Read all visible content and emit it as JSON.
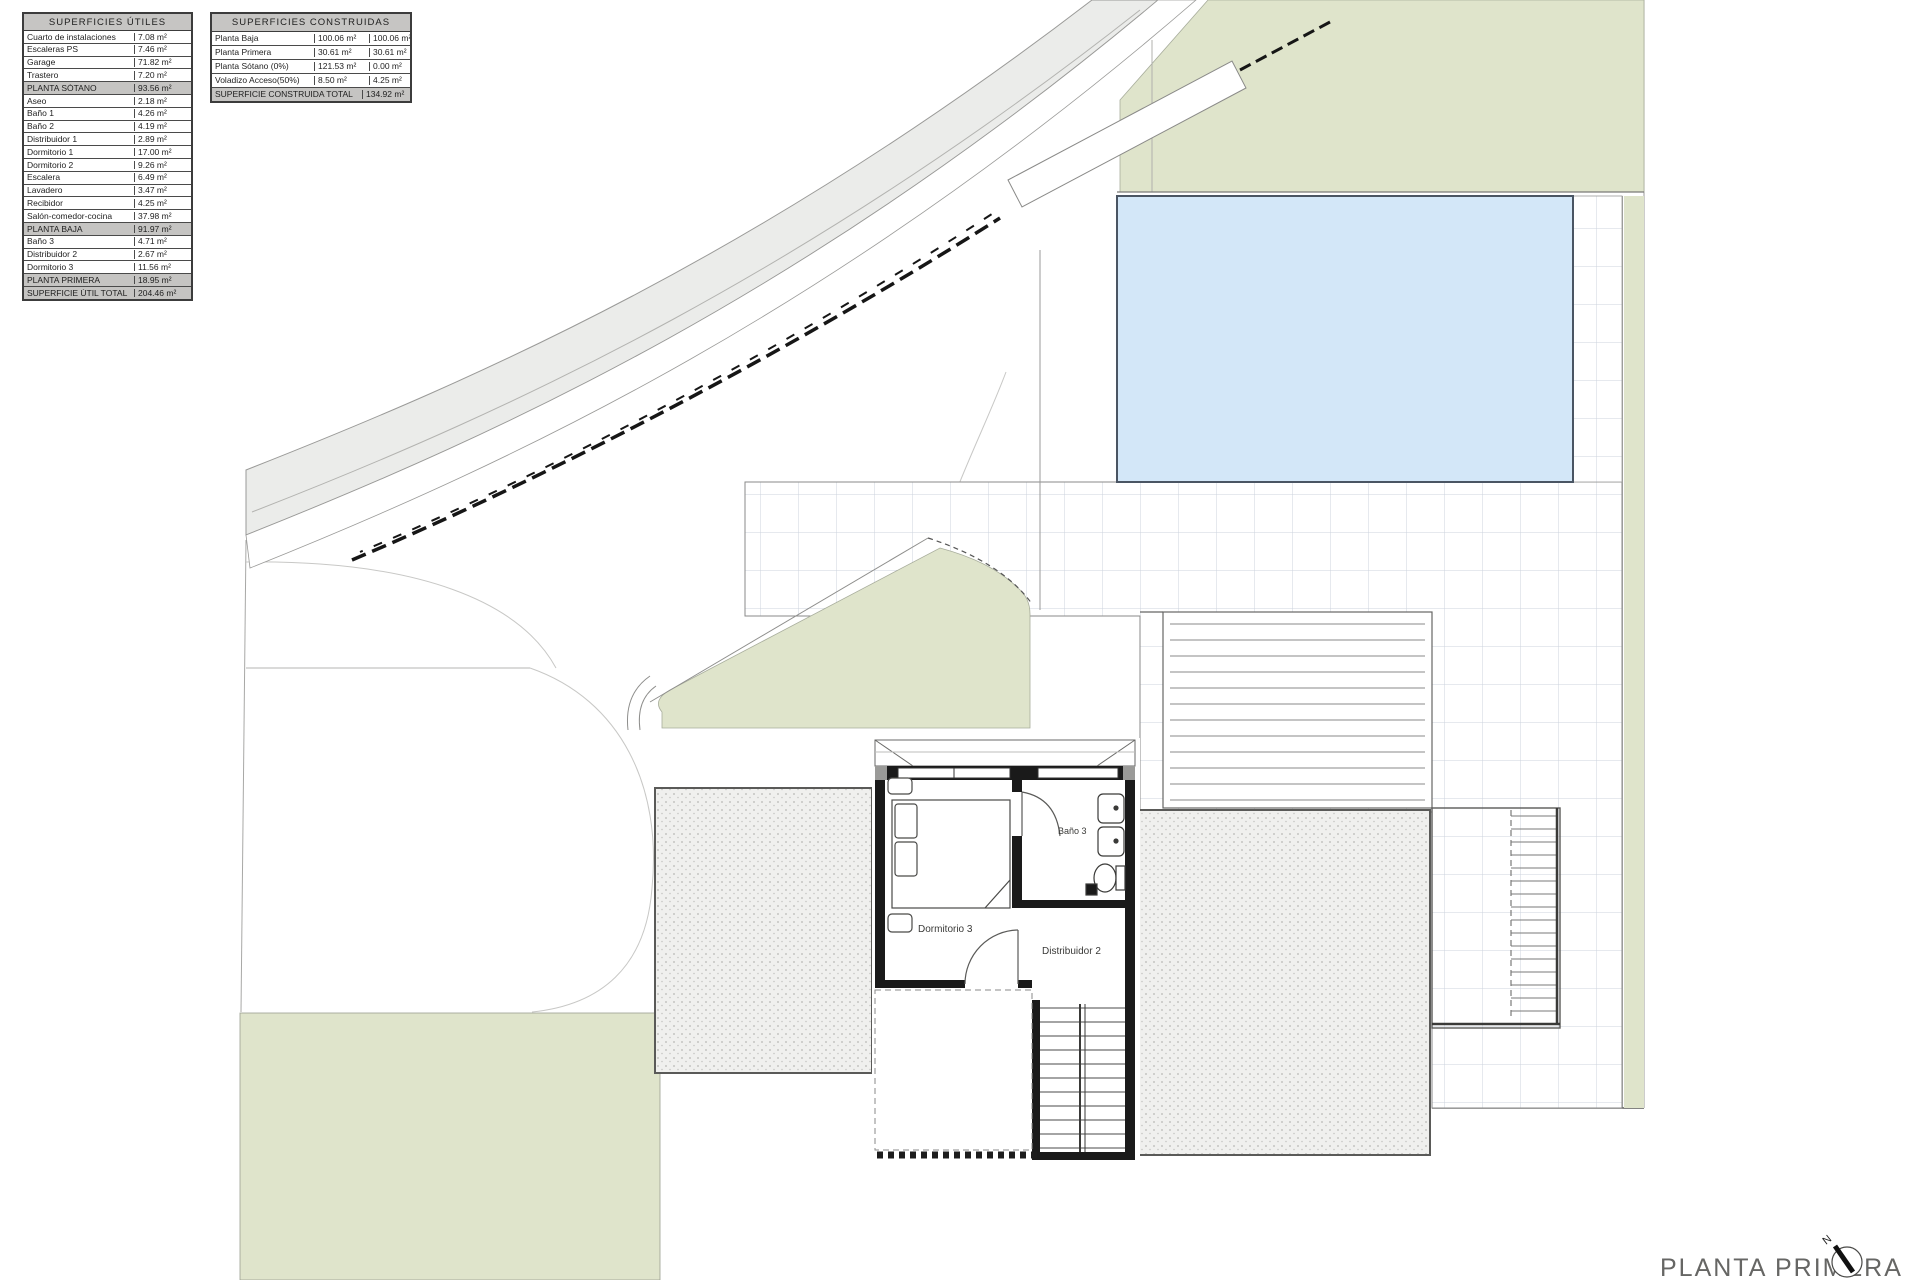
{
  "plan": {
    "title": "PLANTA PRIMERA",
    "north_label": "N",
    "rooms": {
      "dormitorio": "Dormitorio 3",
      "bano": "Baño 3",
      "distribuidor": "Distribuidor 2"
    }
  },
  "tables": {
    "superficies_utiles": {
      "title": "SUPERFICIES ÚTILES",
      "rows": [
        {
          "label": "Cuarto de instalaciones",
          "value": "7.08 m²",
          "type": "normal"
        },
        {
          "label": "Escaleras PS",
          "value": "7.46 m²",
          "type": "normal"
        },
        {
          "label": "Garage",
          "value": "71.82 m²",
          "type": "normal"
        },
        {
          "label": "Trastero",
          "value": "7.20 m²",
          "type": "normal"
        },
        {
          "label": "PLANTA SÓTANO",
          "value": "93.56 m²",
          "type": "subtotal"
        },
        {
          "label": "Aseo",
          "value": "2.18 m²",
          "type": "normal"
        },
        {
          "label": "Baño 1",
          "value": "4.26 m²",
          "type": "normal"
        },
        {
          "label": "Baño 2",
          "value": "4.19 m²",
          "type": "normal"
        },
        {
          "label": "Distribuidor 1",
          "value": "2.89 m²",
          "type": "normal"
        },
        {
          "label": "Dormitorio 1",
          "value": "17.00 m²",
          "type": "normal"
        },
        {
          "label": "Dormitorio 2",
          "value": "9.26 m²",
          "type": "normal"
        },
        {
          "label": "Escalera",
          "value": "6.49 m²",
          "type": "normal"
        },
        {
          "label": "Lavadero",
          "value": "3.47 m²",
          "type": "normal"
        },
        {
          "label": "Recibidor",
          "value": "4.25 m²",
          "type": "normal"
        },
        {
          "label": "Salón-comedor-cocina",
          "value": "37.98 m²",
          "type": "normal"
        },
        {
          "label": "PLANTA BAJA",
          "value": "91.97 m²",
          "type": "subtotal"
        },
        {
          "label": "Baño 3",
          "value": "4.71 m²",
          "type": "normal"
        },
        {
          "label": "Distribuidor 2",
          "value": "2.67 m²",
          "type": "normal"
        },
        {
          "label": "Dormitorio 3",
          "value": "11.56 m²",
          "type": "normal"
        },
        {
          "label": "PLANTA PRIMERA",
          "value": "18.95 m²",
          "type": "subtotal"
        },
        {
          "label": "SUPERFICIE ÚTIL TOTAL",
          "value": "204.46 m²",
          "type": "total"
        }
      ]
    },
    "superficies_construidas": {
      "title": "SUPERFICIES CONSTRUIDAS",
      "rows": [
        {
          "label": "Planta Baja",
          "value1": "100.06 m²",
          "value2": "100.06 m²",
          "type": "normal"
        },
        {
          "label": "Planta Primera",
          "value1": "30.61 m²",
          "value2": "30.61 m²",
          "type": "normal"
        },
        {
          "label": "Planta Sótano (0%)",
          "value1": "121.53 m²",
          "value2": "0.00 m²",
          "type": "normal"
        },
        {
          "label": "Voladizo Acceso(50%)",
          "value1": "8.50 m²",
          "value2": "4.25 m²",
          "type": "normal"
        },
        {
          "label": "SUPERFICIE CONSTRUIDA TOTAL",
          "value2": "134.92 m²",
          "type": "total"
        }
      ]
    }
  },
  "colors": {
    "garden_green": "#dfe4cb",
    "pool_blue": "#d3e7f8",
    "road_gray": "#ebecea",
    "wall_black": "#1a1a1a",
    "tile_grid_line": "#ccd3de",
    "table_header_gray": "#c6c5c3"
  }
}
